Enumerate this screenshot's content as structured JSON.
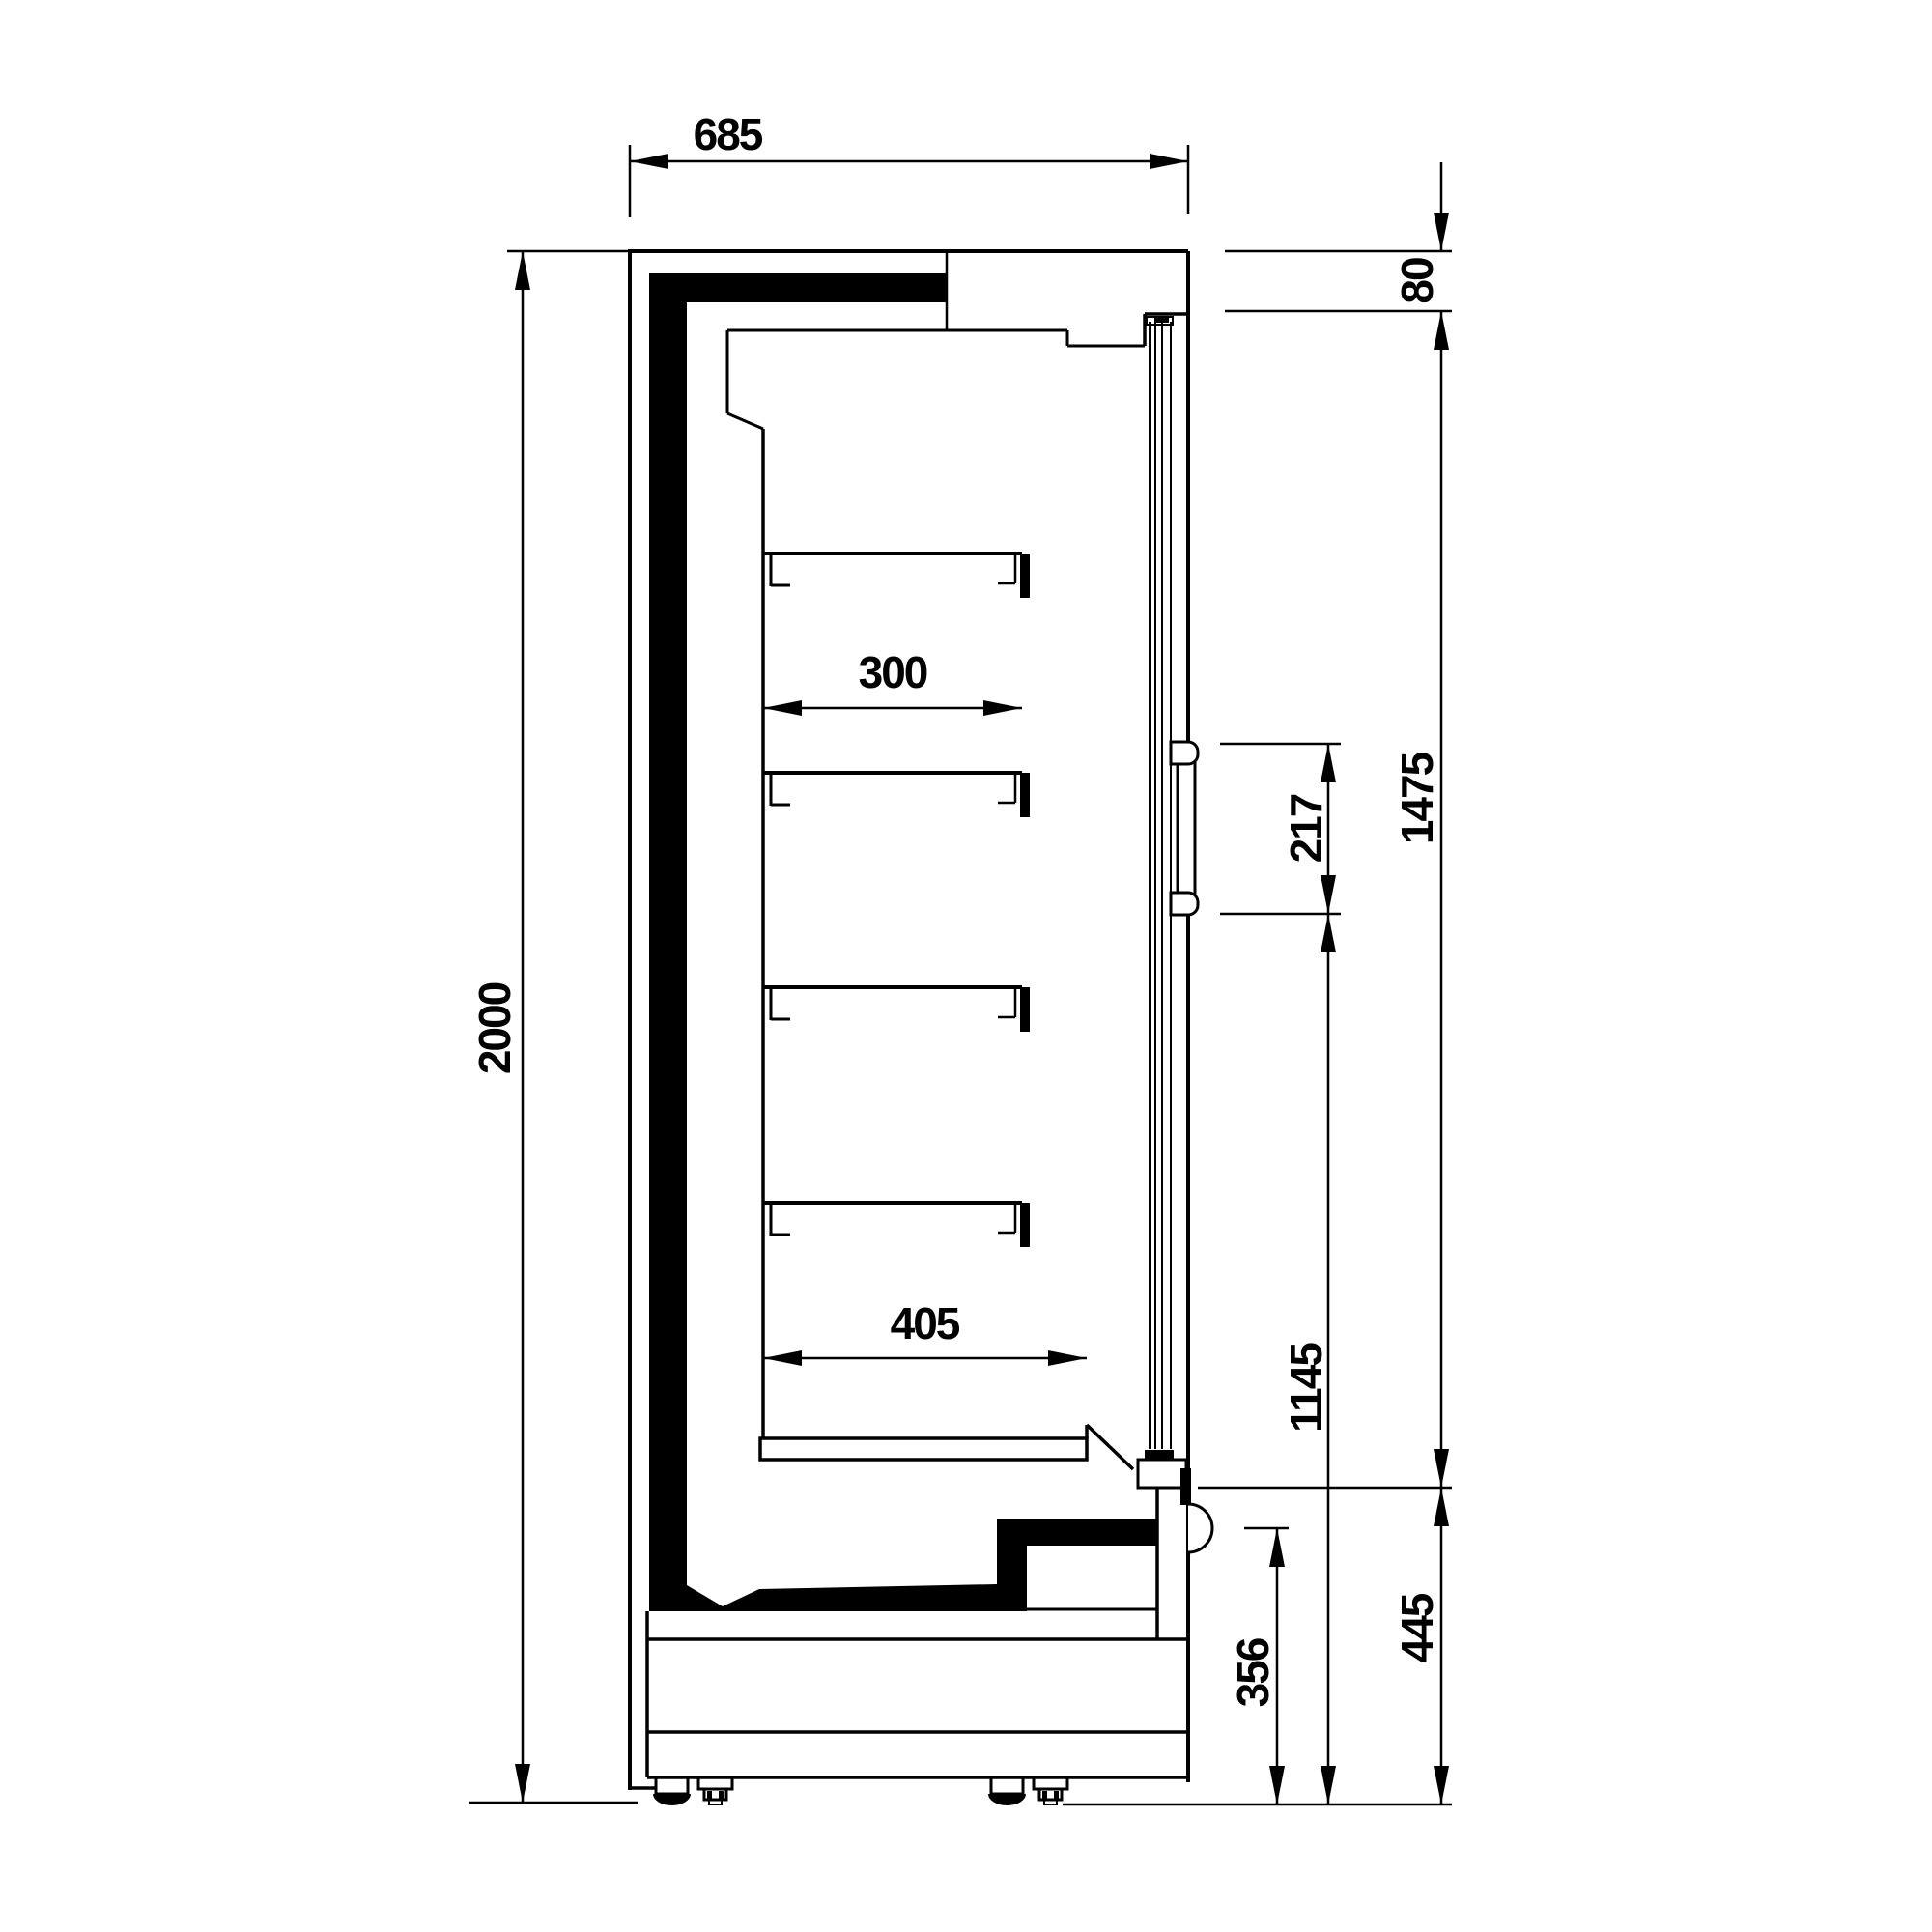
{
  "drawing": {
    "description": "Technical side-section drawing of a glass-door refrigerated wall display cabinet with four shelves, base deck, insulation, handle and adjustable feet",
    "units": "mm",
    "colors": {
      "line": "#000000",
      "background": "#ffffff"
    },
    "dims": {
      "depth_total": "685",
      "height_total": "2000",
      "shelf_depth": "300",
      "base_shelf_depth": "405",
      "top_panel_height": "80",
      "glass_door_height": "1475",
      "handle_length": "217",
      "handle_bottom_to_floor": "1145",
      "sensor_height": "356",
      "base_height": "445"
    }
  }
}
